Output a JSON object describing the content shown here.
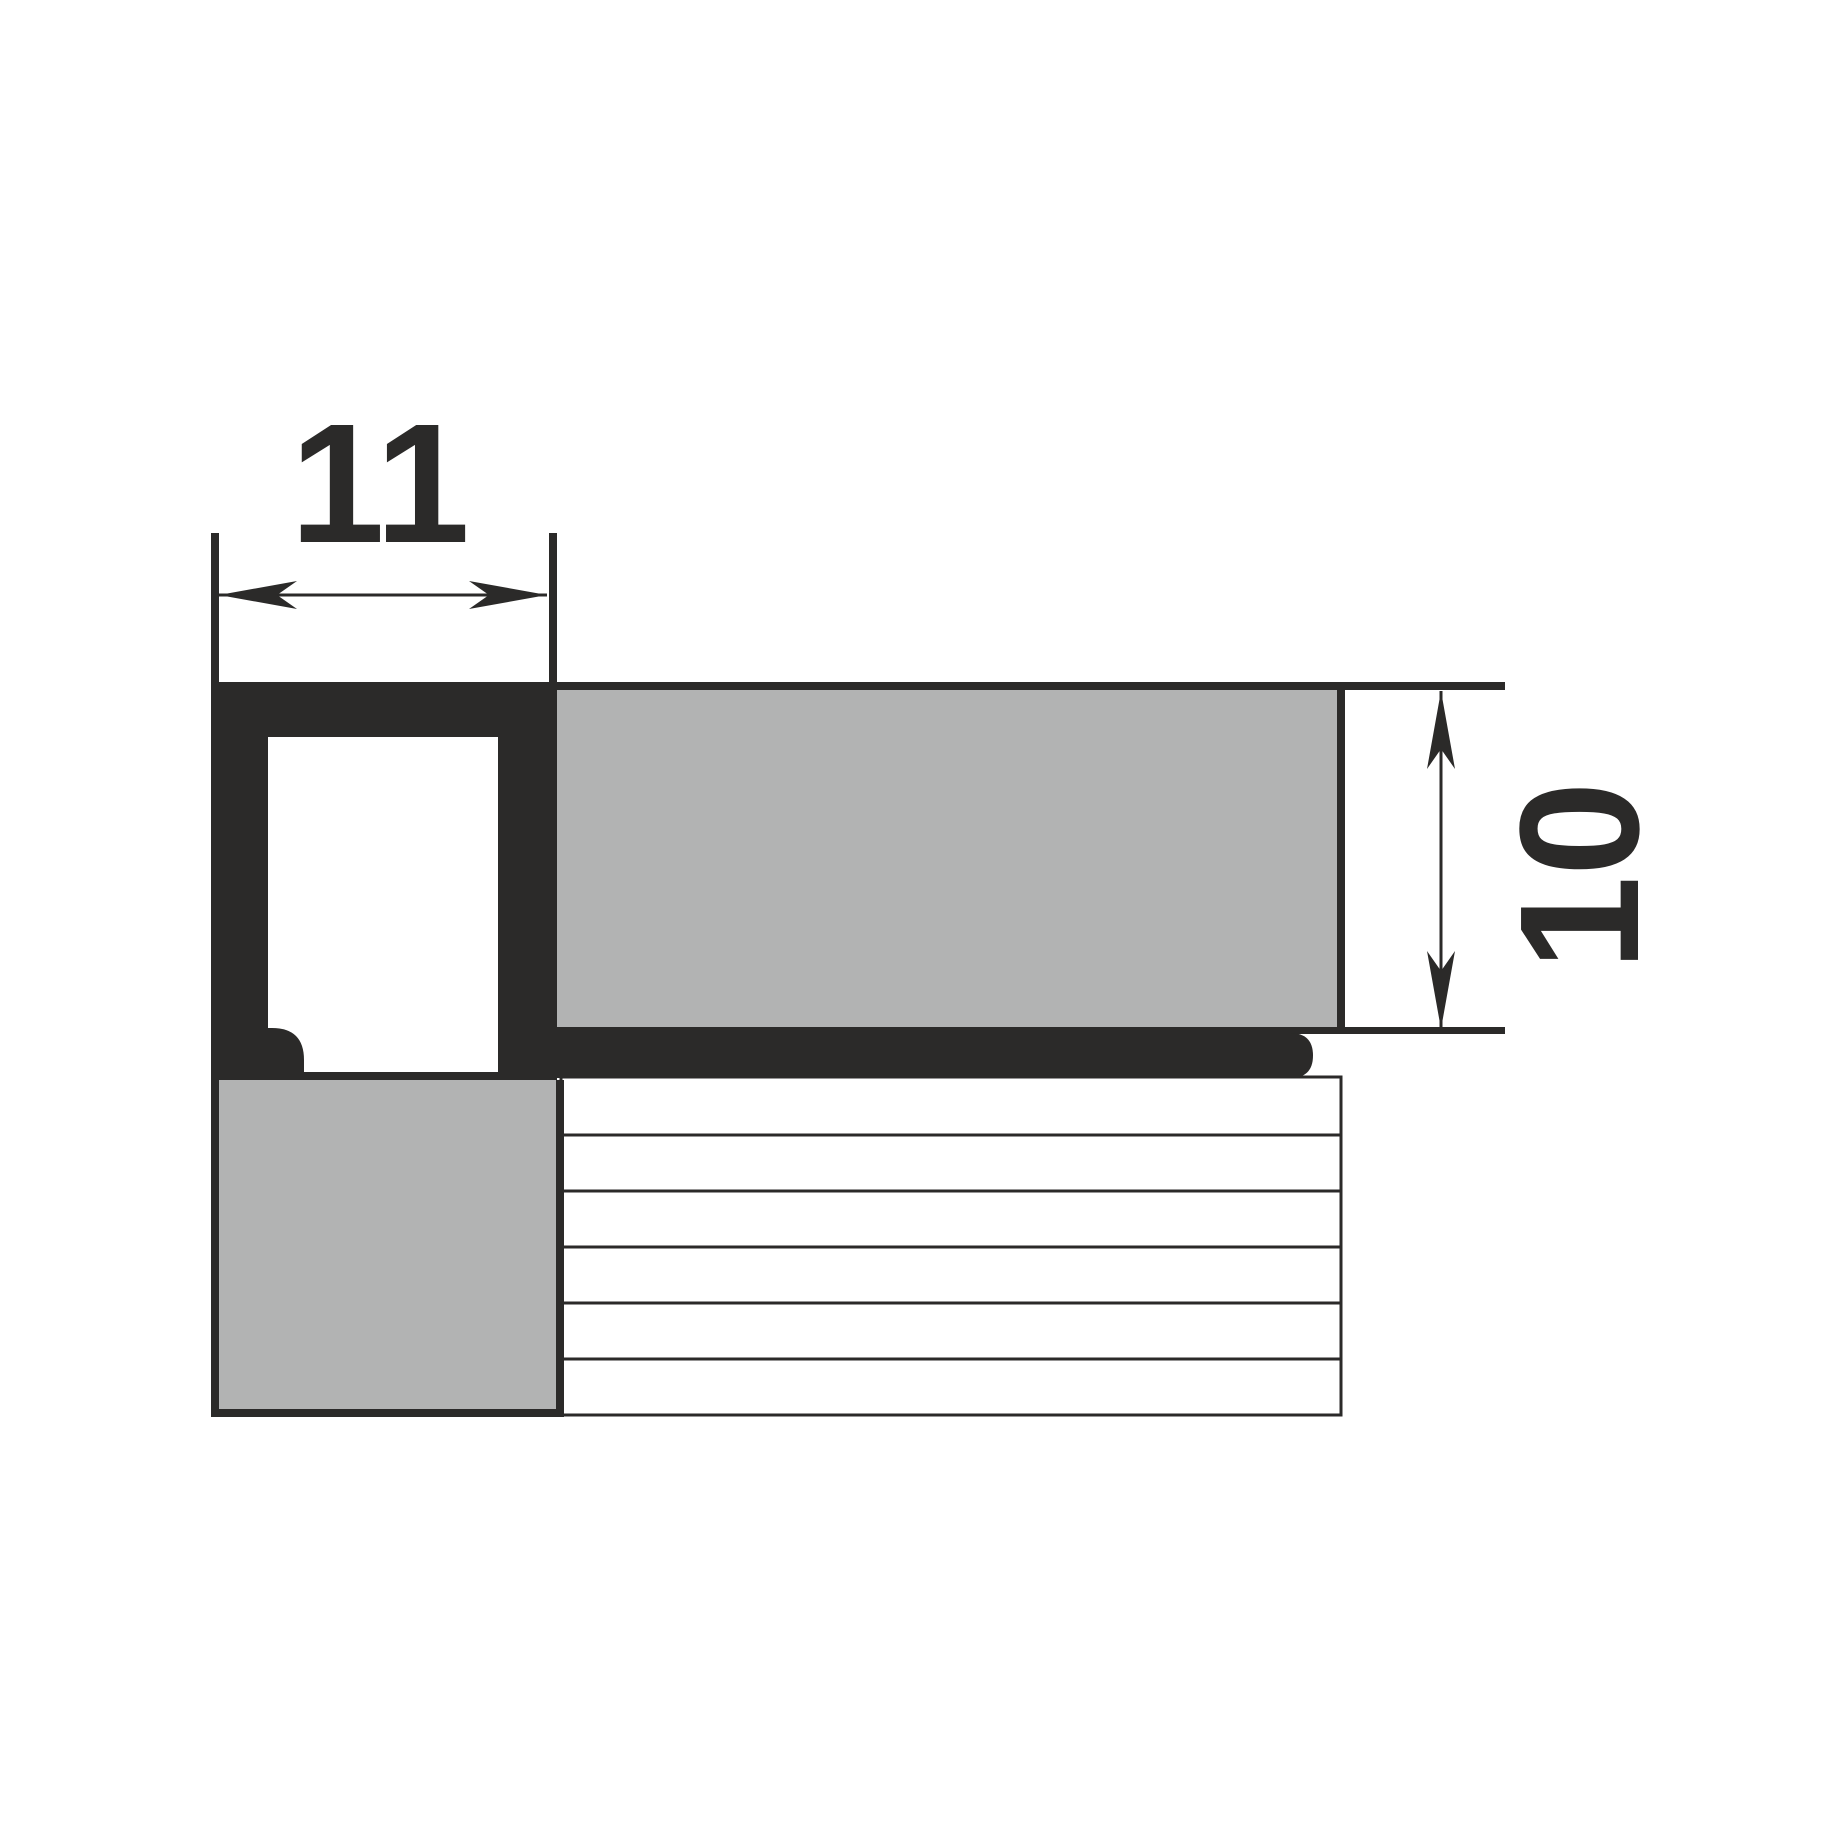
{
  "diagram": {
    "type": "technical-cross-section",
    "dimensions": {
      "width_label": "11",
      "height_label": "10"
    },
    "colors": {
      "outline": "#2b2a29",
      "tile": "#b2b3b3",
      "background": "#ffffff"
    },
    "parts": {
      "profile": "square-box-trim-profile",
      "horizontal_tile": "tile-10mm-thick",
      "vertical_tile": "wall-tile",
      "hatched_area": "adhesive-layer",
      "hatch_line_count": 5
    }
  }
}
